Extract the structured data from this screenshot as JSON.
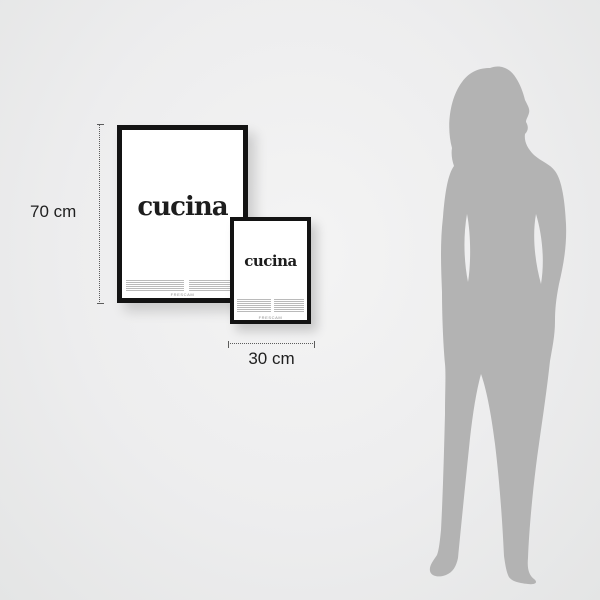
{
  "measurements": {
    "height": {
      "label": "70 cm"
    },
    "width": {
      "label": "30 cm"
    }
  },
  "posters": {
    "large": {
      "title": "cucina",
      "brand": "FRESCAM"
    },
    "small": {
      "title": "cucina",
      "brand": "FRESCAM"
    }
  },
  "figure": {
    "description": "standing woman silhouette for scale",
    "color": "#b3b3b3"
  },
  "colors": {
    "background": "#ededee",
    "frame": "#131313",
    "poster": "#ffffff",
    "title_text": "#1d1d1d",
    "measure_line": "#5c5c5c",
    "label_text": "#1f1f1f",
    "fine_print": "#828282"
  }
}
